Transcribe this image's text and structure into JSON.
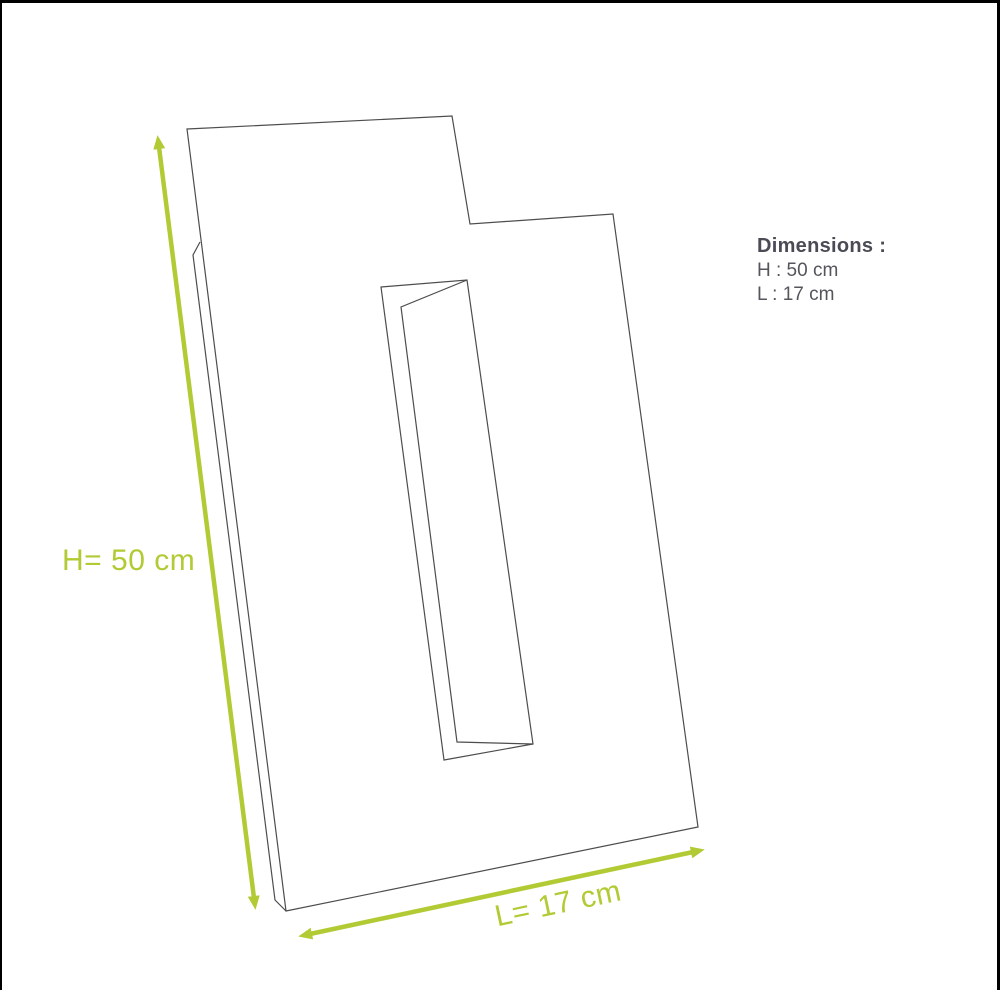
{
  "drawing": {
    "description": "3D line drawing of an extruded panel with a notched top-right corner and a vertical through-slot",
    "line_color": "#4d4d4d"
  },
  "annotations": {
    "height_label": "H= 50 cm",
    "length_label": "L= 17 cm",
    "accent_color": "#b2ca33"
  },
  "dimensions_panel": {
    "title": "Dimensions :",
    "height_line": "H : 50 cm",
    "length_line": "L : 17 cm",
    "text_color": "#4b4b55"
  },
  "frame": {
    "border_color": "#000000"
  }
}
